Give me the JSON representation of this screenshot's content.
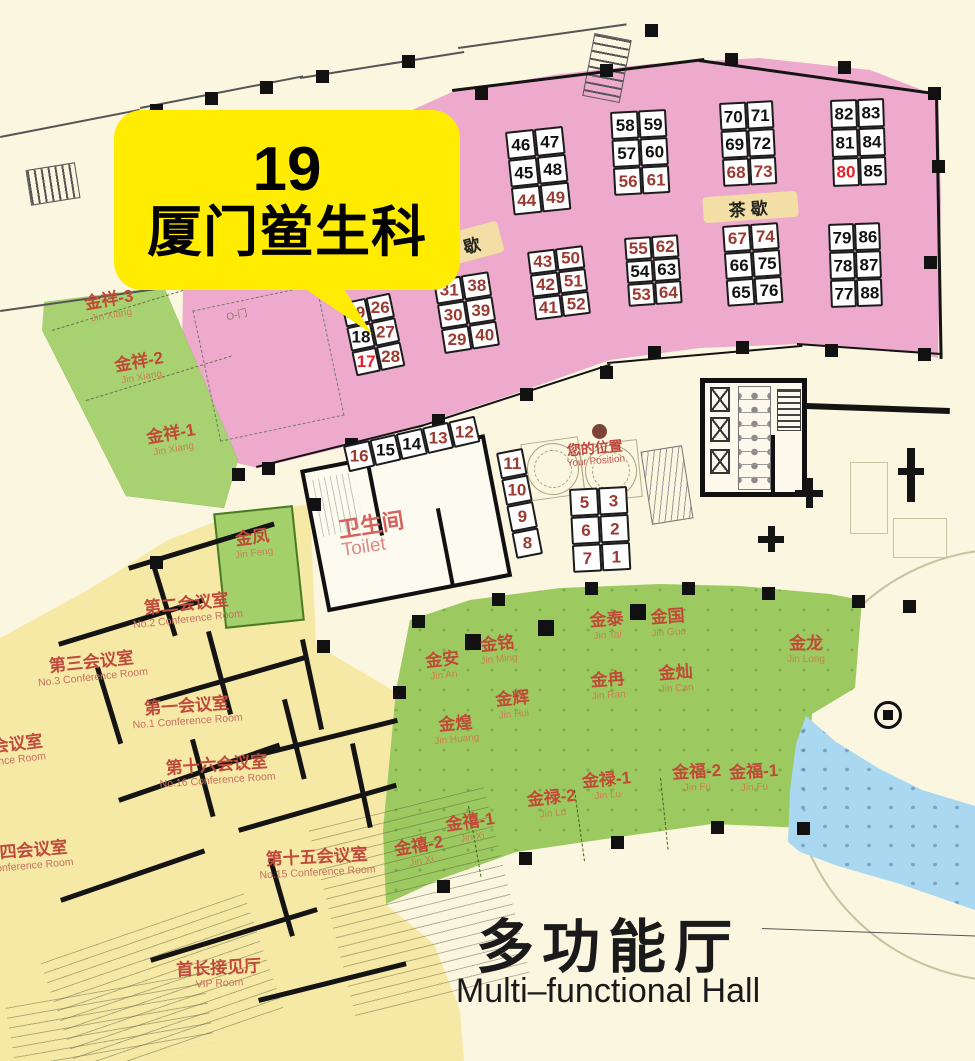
{
  "title": {
    "zh": "多功能厅",
    "en": "Multi–functional Hall"
  },
  "callout": {
    "number": "19",
    "name": "厦门鲎生科"
  },
  "labels": {
    "toilet_zh": "卫生间",
    "toilet_en": "Toilet",
    "your_position_zh": "您的位置",
    "your_position_en": "Your Position",
    "tea_break": "茶歇",
    "door": "O-门"
  },
  "colors": {
    "hall_pink": "#edaacd",
    "banquet_green": "#9cca60",
    "jinxiang_green": "#a8d272",
    "conference_yellow": "#f6e9a6",
    "dining_blue": "#a9d8f0",
    "background_cream": "#fbf6e0",
    "callout_yellow": "#ffec00",
    "booth_maroon": "#9b3a30",
    "booth_highlight_red": "#e81f25",
    "booth_black": "#111111",
    "room_label_red": "#c04a38",
    "tea_band_tan": "#f3dfa5"
  },
  "booth_blocks": [
    {
      "name": "block-17-28",
      "x": 341,
      "y": 303,
      "rot": -12,
      "cellW": 25,
      "cellH": 25,
      "rows": [
        [
          "19",
          "26"
        ],
        [
          "18",
          "27"
        ],
        [
          "17",
          "28"
        ]
      ],
      "styles": [
        [
          "m",
          "m"
        ],
        [
          "k",
          "m"
        ],
        [
          "r",
          "m"
        ]
      ]
    },
    {
      "name": "block-29-40",
      "x": 433,
      "y": 280,
      "rot": -9,
      "cellW": 28,
      "cellH": 25,
      "rows": [
        [
          "31",
          "38"
        ],
        [
          "30",
          "39"
        ],
        [
          "29",
          "40"
        ]
      ],
      "styles": [
        [
          "m",
          "m"
        ],
        [
          "m",
          "m"
        ],
        [
          "m",
          "m"
        ]
      ]
    },
    {
      "name": "block-44-49",
      "x": 505,
      "y": 132,
      "rot": -6,
      "cellW": 29,
      "cellH": 28,
      "rows": [
        [
          "46",
          "47"
        ],
        [
          "45",
          "48"
        ],
        [
          "44",
          "49"
        ]
      ],
      "styles": [
        [
          "k",
          "k"
        ],
        [
          "k",
          "k"
        ],
        [
          "m",
          "m"
        ]
      ]
    },
    {
      "name": "block-41-52",
      "x": 527,
      "y": 252,
      "rot": -7,
      "cellW": 28,
      "cellH": 23,
      "rows": [
        [
          "43",
          "50"
        ],
        [
          "42",
          "51"
        ],
        [
          "41",
          "52"
        ]
      ],
      "styles": [
        [
          "m",
          "m"
        ],
        [
          "m",
          "m"
        ],
        [
          "m",
          "m"
        ]
      ]
    },
    {
      "name": "block-56-61",
      "x": 610,
      "y": 112,
      "rot": -3,
      "cellW": 28,
      "cellH": 28,
      "rows": [
        [
          "58",
          "59"
        ],
        [
          "57",
          "60"
        ],
        [
          "56",
          "61"
        ]
      ],
      "styles": [
        [
          "k",
          "k"
        ],
        [
          "k",
          "k"
        ],
        [
          "m",
          "m"
        ]
      ]
    },
    {
      "name": "block-53-64",
      "x": 624,
      "y": 238,
      "rot": -4,
      "cellW": 27,
      "cellH": 23,
      "rows": [
        [
          "55",
          "62"
        ],
        [
          "54",
          "63"
        ],
        [
          "53",
          "64"
        ]
      ],
      "styles": [
        [
          "m",
          "m"
        ],
        [
          "k",
          "k"
        ],
        [
          "m",
          "m"
        ]
      ]
    },
    {
      "name": "block-68-73",
      "x": 719,
      "y": 103,
      "rot": -3,
      "cellW": 27,
      "cellH": 28,
      "rows": [
        [
          "70",
          "71"
        ],
        [
          "69",
          "72"
        ],
        [
          "68",
          "73"
        ]
      ],
      "styles": [
        [
          "k",
          "k"
        ],
        [
          "k",
          "k"
        ],
        [
          "m",
          "m"
        ]
      ]
    },
    {
      "name": "block-65-76",
      "x": 722,
      "y": 226,
      "rot": -4,
      "cellW": 28,
      "cellH": 27,
      "rows": [
        [
          "67",
          "74"
        ],
        [
          "66",
          "75"
        ],
        [
          "65",
          "76"
        ]
      ],
      "styles": [
        [
          "m",
          "m"
        ],
        [
          "k",
          "k"
        ],
        [
          "k",
          "k"
        ]
      ]
    },
    {
      "name": "block-80-85",
      "x": 830,
      "y": 100,
      "rot": -2,
      "cellW": 27,
      "cellH": 29,
      "rows": [
        [
          "82",
          "83"
        ],
        [
          "81",
          "84"
        ],
        [
          "80",
          "85"
        ]
      ],
      "styles": [
        [
          "k",
          "k"
        ],
        [
          "k",
          "k"
        ],
        [
          "r",
          "k"
        ]
      ]
    },
    {
      "name": "block-77-88",
      "x": 828,
      "y": 224,
      "rot": -2,
      "cellW": 26,
      "cellH": 28,
      "rows": [
        [
          "79",
          "86"
        ],
        [
          "78",
          "87"
        ],
        [
          "77",
          "88"
        ]
      ],
      "styles": [
        [
          "k",
          "k"
        ],
        [
          "k",
          "k"
        ],
        [
          "k",
          "k"
        ]
      ]
    },
    {
      "name": "block-1-7",
      "x": 569,
      "y": 489,
      "rot": -3,
      "cellW": 29,
      "cellH": 28,
      "rows": [
        [
          "5",
          "3"
        ],
        [
          "6",
          "2"
        ],
        [
          "7",
          "1"
        ]
      ],
      "styles": [
        [
          "m",
          "m"
        ],
        [
          "m",
          "m"
        ],
        [
          "m",
          "m"
        ]
      ]
    },
    {
      "name": "row-12-16",
      "x": 343,
      "y": 446,
      "rot": -13,
      "cellW": 27,
      "cellH": 27,
      "rows": [
        [
          "16",
          "15",
          "14",
          "13",
          "12"
        ]
      ],
      "styles": [
        [
          "m",
          "k",
          "k",
          "m",
          "m"
        ]
      ]
    },
    {
      "name": "col-8-11",
      "x": 496,
      "y": 453,
      "rot": -11,
      "cellW": 27,
      "cellH": 27,
      "rows": [
        [
          "11"
        ],
        [
          "10"
        ],
        [
          "9"
        ],
        [
          "8"
        ]
      ],
      "styles": [
        [
          "m"
        ],
        [
          "m"
        ],
        [
          "m"
        ],
        [
          "m"
        ]
      ]
    }
  ],
  "banquet_rooms": [
    {
      "zh": "金祥-3",
      "py": "Jin Xiang",
      "x": 110,
      "y": 306,
      "rot": -10
    },
    {
      "zh": "金祥-2",
      "py": "Jin Xiang",
      "x": 140,
      "y": 368,
      "rot": -10
    },
    {
      "zh": "金祥-1",
      "py": "Jin Xiang",
      "x": 172,
      "y": 440,
      "rot": -10
    },
    {
      "zh": "金凤",
      "py": "Jin Feng",
      "x": 253,
      "y": 544,
      "rot": -7
    },
    {
      "zh": "金安",
      "py": "Jin An",
      "x": 443,
      "y": 666,
      "rot": -6
    },
    {
      "zh": "金铭",
      "py": "Jin Ming",
      "x": 498,
      "y": 650,
      "rot": -6
    },
    {
      "zh": "金泰",
      "py": "Jin Tai",
      "x": 607,
      "y": 626,
      "rot": -4
    },
    {
      "zh": "金国",
      "py": "Jin Guo",
      "x": 668,
      "y": 623,
      "rot": -4
    },
    {
      "zh": "金冉",
      "py": "Jin Ran",
      "x": 608,
      "y": 686,
      "rot": -4
    },
    {
      "zh": "金灿",
      "py": "Jin Can",
      "x": 676,
      "y": 679,
      "rot": -4
    },
    {
      "zh": "金辉",
      "py": "Jin Hui",
      "x": 513,
      "y": 705,
      "rot": -5
    },
    {
      "zh": "金煌",
      "py": "Jin Huang",
      "x": 456,
      "y": 730,
      "rot": -5
    },
    {
      "zh": "金龙",
      "py": "Jin Long",
      "x": 806,
      "y": 650,
      "rot": 0
    },
    {
      "zh": "金福-2",
      "py": "Jin Fu",
      "x": 697,
      "y": 778,
      "rot": -3
    },
    {
      "zh": "金福-1",
      "py": "Jin Fu",
      "x": 754,
      "y": 778,
      "rot": -3
    },
    {
      "zh": "金禄-2",
      "py": "Jin Lu",
      "x": 552,
      "y": 804,
      "rot": -6
    },
    {
      "zh": "金禄-1",
      "py": "Jin Lu",
      "x": 607,
      "y": 786,
      "rot": -5
    },
    {
      "zh": "金禧-1",
      "py": "Jin Xi",
      "x": 471,
      "y": 828,
      "rot": -8
    },
    {
      "zh": "金禧-2",
      "py": "Jin Xi",
      "x": 420,
      "y": 852,
      "rot": -10
    }
  ],
  "conference_rooms": [
    {
      "zh": "第二会议室",
      "en": "No.2 Conference Room",
      "x": 187,
      "y": 610,
      "rot": -6
    },
    {
      "zh": "第三会议室",
      "en": "No.3 Conference Room",
      "x": 92,
      "y": 668,
      "rot": -6
    },
    {
      "zh": "第一会议室",
      "en": "No.1 Conference Room",
      "x": 187,
      "y": 712,
      "rot": -4
    },
    {
      "zh": "第十六会议室",
      "en": "No.16 Conference Room",
      "x": 217,
      "y": 771,
      "rot": -4
    },
    {
      "zh": "第十五会议室",
      "en": "No.15 Conference Room",
      "x": 317,
      "y": 863,
      "rot": -3
    },
    {
      "zh": "首长接见厅",
      "en": "VIP Room",
      "x": 219,
      "y": 974,
      "rot": -3
    },
    {
      "zh": "会议室",
      "en": "ence Room",
      "x": 18,
      "y": 750,
      "rot": -7
    },
    {
      "zh": "四会议室",
      "en": "onference Room",
      "x": 34,
      "y": 856,
      "rot": -5
    }
  ]
}
